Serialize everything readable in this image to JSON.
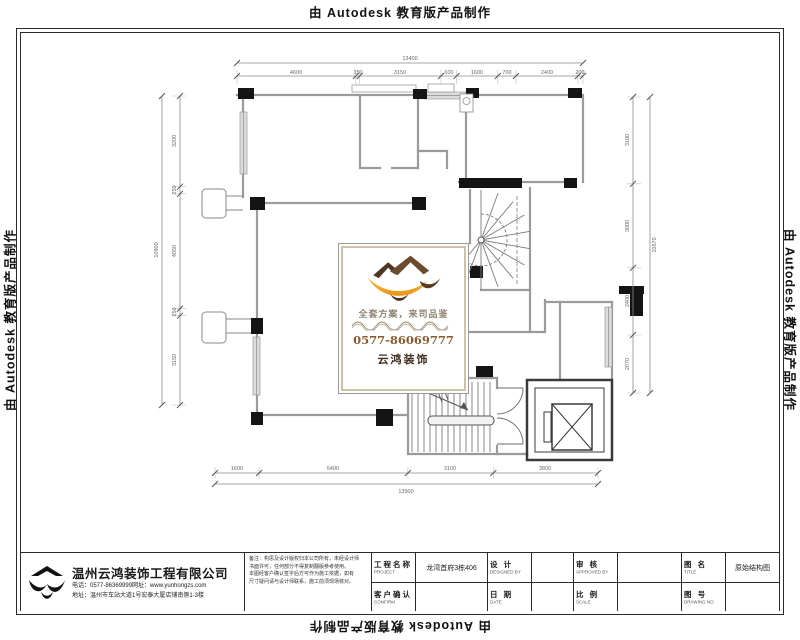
{
  "autodesk_notice": "由 Autodesk 教育版产品制作",
  "watermark": {
    "slogan": "全套方案，来司品鉴",
    "phone": "0577-86069777",
    "brand": "云鸿装饰",
    "colors": {
      "gold": "#F0A51C",
      "roof_brown": "#6B4A2E",
      "dark_brown": "#4E3722",
      "phone_text": "#8A5A2E"
    }
  },
  "title_block": {
    "company": {
      "name": "温州云鸿装饰工程有限公司",
      "phone_line": "电话：0577-86369999网址：www.yunhongzs.com",
      "address_line": "地址：温州市车站大道1号宏泰大厦店铺南侧1-3楼"
    },
    "remarks": [
      "备注：构思及设计版权归本公司所有，未经设计师",
      "书面许可，任何部分不得复制翻版参考使用。",
      "本图经客户确认签字后方可作为施工依据，如有",
      "尺寸疑问请与设计师联系，施工前须现场核对。"
    ],
    "fields": [
      {
        "label": "工程名称",
        "sub": "PROJECT",
        "value": "龙湾首府3栋406"
      },
      {
        "label": "设  计",
        "sub": "DESIGNED BY",
        "value": ""
      },
      {
        "label": "审  核",
        "sub": "APPROVED BY",
        "value": ""
      },
      {
        "label": "图  名",
        "sub": "TITLE",
        "value": "原始结构图"
      },
      {
        "label": "客户确认",
        "sub": "CONFIRM",
        "value": ""
      },
      {
        "label": "日  期",
        "sub": "DATE",
        "value": ""
      },
      {
        "label": "比  例",
        "sub": "SCALE",
        "value": ""
      },
      {
        "label": "图  号",
        "sub": "DRAWING NO",
        "value": ""
      }
    ]
  },
  "plan": {
    "dims": {
      "top": {
        "overall": "13400",
        "segments": [
          "4600",
          "150",
          "3150",
          "600",
          "1600",
          "700",
          "2400",
          "200"
        ]
      },
      "left": {
        "overall": "10900",
        "segments": [
          "3200",
          "250",
          "4050",
          "250",
          "3150"
        ]
      },
      "right": {
        "overall": "10570",
        "segments": [
          "3100",
          "3000",
          "2400",
          "2070"
        ]
      },
      "bottom": {
        "overall": "13900",
        "segments": [
          "1600",
          "5400",
          "3100",
          "3800"
        ]
      }
    }
  }
}
